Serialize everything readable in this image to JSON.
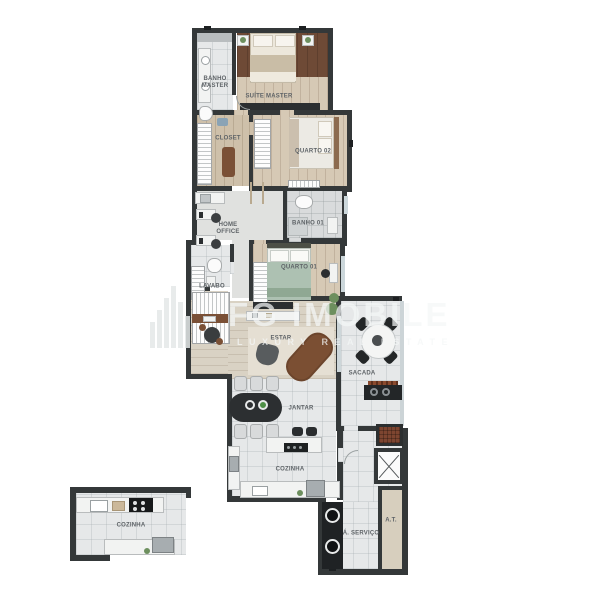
{
  "document": {
    "type": "apartment-floor-plan-render",
    "background": "#ffffff"
  },
  "watermark": {
    "brand": "FG IMOBILE",
    "tagline": "LUXURY REAL ESTATE",
    "logo": "vertical-bars-logo",
    "color": "#ffffff"
  },
  "palette": {
    "wall": "#343839",
    "wood_floor": "#d6c9b5",
    "dark_wood_headboard": "#6e4a36",
    "tile_floor": "#e6e8e9",
    "sage_bed": "#adc1b2",
    "brown_chaise": "#7b4f33",
    "grill_brick": "#7d4530",
    "appliance_black": "#1f2224",
    "at_floor": "#d7cfbe"
  },
  "rooms": {
    "banho_master": {
      "label": "BANHO\nMASTER"
    },
    "suite_master": {
      "label": "SUÍTE MASTER"
    },
    "closet": {
      "label": "CLOSET"
    },
    "quarto02": {
      "label": "QUARTO 02"
    },
    "home_office": {
      "label": "HOME\nOFFICE"
    },
    "banho01": {
      "label": "BANHO 01"
    },
    "quarto01": {
      "label": "QUARTO 01"
    },
    "lavabo": {
      "label": "LAVABO"
    },
    "estar": {
      "label": "ESTAR"
    },
    "sacada": {
      "label": "SACADA"
    },
    "jantar": {
      "label": "JANTAR"
    },
    "cozinha": {
      "label": "COZINHA"
    },
    "servico": {
      "label": "Á. SERVIÇO"
    },
    "area_tecnica": {
      "label": "A.T."
    },
    "cozinha_detail": {
      "label": "COZINHA"
    }
  }
}
